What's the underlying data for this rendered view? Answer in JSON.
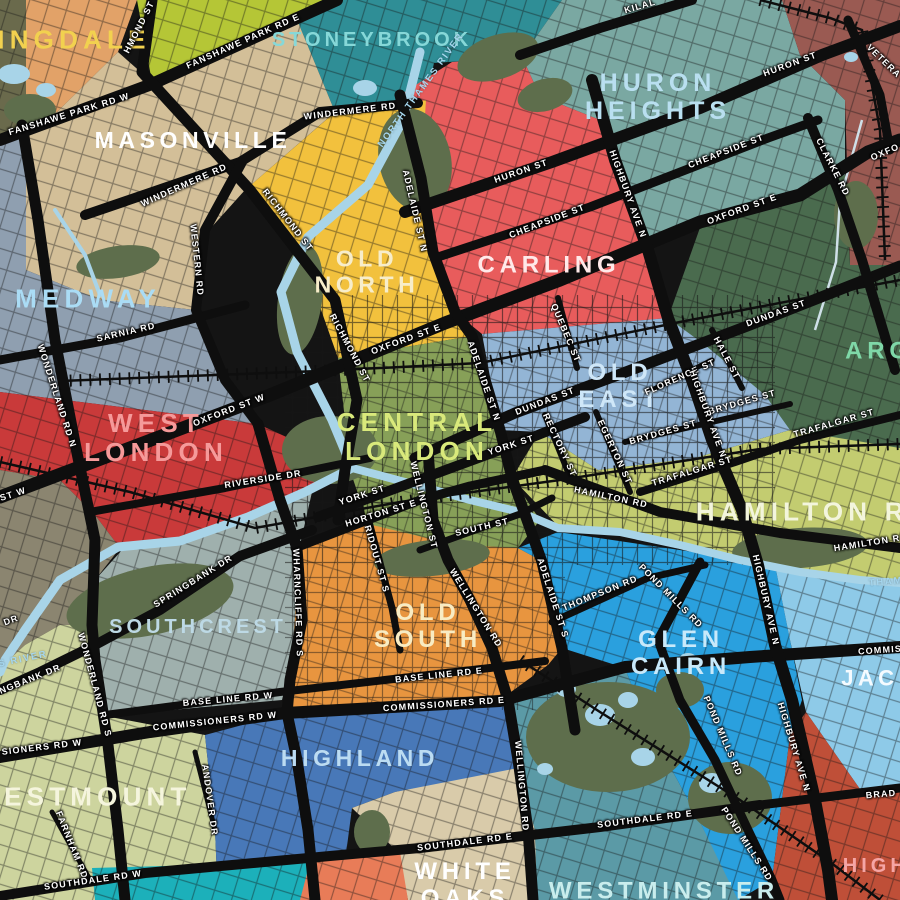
{
  "palette": {
    "background": "#141414",
    "road": "#0e0e0e",
    "rail": "#0e0e0e",
    "water": "#a8d4e8",
    "creek": "#cfe0e8",
    "park": "#5e6e4c"
  },
  "regions": [
    {
      "id": "corner-olive",
      "fill": "#6a6a4c"
    },
    {
      "id": "sunningdale",
      "fill": "#e2a268"
    },
    {
      "id": "lime-north",
      "fill": "#b5c636"
    },
    {
      "id": "stoneybrook",
      "fill": "#2f8e96"
    },
    {
      "id": "huron-heights",
      "fill": "#7aa8a2"
    },
    {
      "id": "northeast-maroon",
      "fill": "#9a5a52"
    },
    {
      "id": "argyle-green",
      "fill": "#4a6b4e"
    },
    {
      "id": "carling",
      "fill": "#e85c5c"
    },
    {
      "id": "old-north",
      "fill": "#f2c13d"
    },
    {
      "id": "masonville",
      "fill": "#d3bf98"
    },
    {
      "id": "medway",
      "fill": "#8f9fb0"
    },
    {
      "id": "west-london",
      "fill": "#c93a3a"
    },
    {
      "id": "oakridge-olive",
      "fill": "#8b8570"
    },
    {
      "id": "hamilton-road",
      "fill": "#c3cc70"
    },
    {
      "id": "central-london",
      "fill": "#87a058"
    },
    {
      "id": "old-east",
      "fill": "#93b5d5"
    },
    {
      "id": "old-south",
      "fill": "#e8953f"
    },
    {
      "id": "southcrest",
      "fill": "#9fb0ad"
    },
    {
      "id": "westmount",
      "fill": "#cdd49e"
    },
    {
      "id": "highland",
      "fill": "#4878b8"
    },
    {
      "id": "white-oaks",
      "fill": "#d9cbaa"
    },
    {
      "id": "westminster",
      "fill": "#5b9aa6"
    },
    {
      "id": "glen-cairn",
      "fill": "#2aa0de"
    },
    {
      "id": "jackson",
      "fill": "#8ecae8"
    },
    {
      "id": "highbury",
      "fill": "#bf4f38"
    },
    {
      "id": "bottom-teal",
      "fill": "#1cb0ba"
    },
    {
      "id": "bottom-coral",
      "fill": "#e87c58"
    }
  ],
  "neighbourhoods": [
    {
      "id": "sunningdale",
      "lines": [
        "NINGDALE"
      ],
      "x": 62,
      "y": 40,
      "size": 26,
      "color": "#f2d14f",
      "rot": 0
    },
    {
      "id": "masonville",
      "lines": [
        "MASONVILLE"
      ],
      "x": 193,
      "y": 141,
      "size": 23,
      "color": "#ffffff",
      "rot": 0
    },
    {
      "id": "stoneybrook",
      "lines": [
        "STONEYBROOK"
      ],
      "x": 372,
      "y": 40,
      "size": 20,
      "color": "#86d8d8",
      "rot": 0
    },
    {
      "id": "huron-heights",
      "lines": [
        "HURON",
        "HEIGHTS"
      ],
      "x": 658,
      "y": 97,
      "size": 25,
      "color": "#b9dff0",
      "rot": 0
    },
    {
      "id": "medway",
      "lines": [
        "MEDWAY"
      ],
      "x": 88,
      "y": 299,
      "size": 26,
      "color": "#aadcf5",
      "rot": 0
    },
    {
      "id": "old-north",
      "lines": [
        "OLD",
        "NORTH"
      ],
      "x": 367,
      "y": 272,
      "size": 23,
      "color": "#f7edca",
      "rot": 0
    },
    {
      "id": "carling",
      "lines": [
        "CARLING"
      ],
      "x": 549,
      "y": 266,
      "size": 24,
      "color": "#ffe9e9",
      "rot": 0
    },
    {
      "id": "west-london",
      "lines": [
        "WEST",
        "LONDON"
      ],
      "x": 156,
      "y": 438,
      "size": 26,
      "color": "#f59a9a",
      "rot": 0
    },
    {
      "id": "central-london",
      "lines": [
        "CENTRAL",
        "LONDON"
      ],
      "x": 417,
      "y": 437,
      "size": 26,
      "color": "#d9e97b",
      "rot": 0
    },
    {
      "id": "old-east",
      "lines": [
        "OLD",
        "EAST"
      ],
      "x": 620,
      "y": 387,
      "size": 24,
      "color": "#cfe7f8",
      "rot": 0
    },
    {
      "id": "hamilton-road",
      "lines": [
        "HAMILTON RO"
      ],
      "x": 815,
      "y": 512,
      "size": 26,
      "color": "#f3f5dc",
      "rot": 0
    },
    {
      "id": "argyle",
      "lines": [
        "ARG"
      ],
      "x": 879,
      "y": 352,
      "size": 24,
      "color": "#7fd8a8",
      "rot": 0
    },
    {
      "id": "old-south",
      "lines": [
        "OLD",
        "SOUTH"
      ],
      "x": 428,
      "y": 627,
      "size": 24,
      "color": "#f8ecc3",
      "rot": 0
    },
    {
      "id": "glen-cairn",
      "lines": [
        "GLEN",
        "CAIRN"
      ],
      "x": 681,
      "y": 654,
      "size": 24,
      "color": "#c8e9fa",
      "rot": 0
    },
    {
      "id": "southcrest",
      "lines": [
        "SOUTHCREST"
      ],
      "x": 198,
      "y": 627,
      "size": 20,
      "color": "#bdd9e5",
      "rot": 0
    },
    {
      "id": "westmount",
      "lines": [
        "WESTMOUNT"
      ],
      "x": 83,
      "y": 797,
      "size": 26,
      "color": "#f5f5dd",
      "rot": 0
    },
    {
      "id": "highland",
      "lines": [
        "HIGHLAND"
      ],
      "x": 360,
      "y": 759,
      "size": 23,
      "color": "#bcdcf2",
      "rot": 0
    },
    {
      "id": "white-oaks",
      "lines": [
        "WHITE",
        "OAKS"
      ],
      "x": 465,
      "y": 886,
      "size": 24,
      "color": "#ffffff",
      "rot": 0
    },
    {
      "id": "westminster",
      "lines": [
        "WESTMINSTER"
      ],
      "x": 664,
      "y": 892,
      "size": 24,
      "color": "#c9eded",
      "rot": 0
    },
    {
      "id": "jackson",
      "lines": [
        "JACK"
      ],
      "x": 880,
      "y": 679,
      "size": 22,
      "color": "#f5fbff",
      "rot": 0
    },
    {
      "id": "highbury",
      "lines": [
        "HIGHB"
      ],
      "x": 885,
      "y": 866,
      "size": 20,
      "color": "#f5a5a5",
      "rot": 0
    }
  ],
  "streets": [
    {
      "t": "FANSHAWE PARK RD W",
      "x": 69,
      "y": 114,
      "r": -17
    },
    {
      "t": "FANSHAWE PARK RD E",
      "x": 243,
      "y": 41,
      "r": -24
    },
    {
      "t": "HMOND ST",
      "x": 139,
      "y": 27,
      "r": -63
    },
    {
      "t": "KILAL",
      "x": 640,
      "y": 6,
      "r": -16
    },
    {
      "t": "HURON ST",
      "x": 790,
      "y": 64,
      "r": -20
    },
    {
      "t": "VETERA",
      "x": 884,
      "y": 61,
      "r": 44
    },
    {
      "t": "WINDERMERE RD",
      "x": 350,
      "y": 111,
      "r": -7
    },
    {
      "t": "WINDERMERE RD",
      "x": 184,
      "y": 185,
      "r": -24
    },
    {
      "t": "RICHMOND ST",
      "x": 288,
      "y": 220,
      "r": 52
    },
    {
      "t": "ADELAIDE ST N",
      "x": 415,
      "y": 211,
      "r": 77
    },
    {
      "t": "WESTERN RD",
      "x": 197,
      "y": 260,
      "r": 84
    },
    {
      "t": "CHEAPSIDE ST",
      "x": 726,
      "y": 151,
      "r": -21
    },
    {
      "t": "CHEAPSIDE ST",
      "x": 547,
      "y": 221,
      "r": -21
    },
    {
      "t": "HURON ST",
      "x": 521,
      "y": 171,
      "r": -19
    },
    {
      "t": "HIGHBURY AVE N",
      "x": 628,
      "y": 194,
      "r": 70
    },
    {
      "t": "CLARKE RD",
      "x": 833,
      "y": 167,
      "r": 63
    },
    {
      "t": "OXFO",
      "x": 885,
      "y": 152,
      "r": -23
    },
    {
      "t": "OXFORD ST E",
      "x": 742,
      "y": 209,
      "r": -20
    },
    {
      "t": "OXFORD ST E",
      "x": 406,
      "y": 339,
      "r": -20
    },
    {
      "t": "OXFORD ST W",
      "x": 229,
      "y": 410,
      "r": -21
    },
    {
      "t": "ST W",
      "x": 13,
      "y": 494,
      "r": -18
    },
    {
      "t": "SARNIA RD",
      "x": 126,
      "y": 332,
      "r": -13
    },
    {
      "t": "WONDERLAND RD N",
      "x": 57,
      "y": 396,
      "r": 72
    },
    {
      "t": "RICHMOND ST",
      "x": 350,
      "y": 348,
      "r": 62
    },
    {
      "t": "QUEBEC ST",
      "x": 566,
      "y": 333,
      "r": 67
    },
    {
      "t": "DUNDAS ST",
      "x": 545,
      "y": 401,
      "r": -21
    },
    {
      "t": "DUNDAS ST",
      "x": 776,
      "y": 313,
      "r": -20
    },
    {
      "t": "FLORENCE ST",
      "x": 680,
      "y": 377,
      "r": -24
    },
    {
      "t": "HALE ST",
      "x": 727,
      "y": 358,
      "r": 62
    },
    {
      "t": "BRYDGES ST",
      "x": 663,
      "y": 432,
      "r": -16
    },
    {
      "t": "BRYDGES ST",
      "x": 742,
      "y": 402,
      "r": -16
    },
    {
      "t": "EGERTON ST",
      "x": 615,
      "y": 452,
      "r": 65
    },
    {
      "t": "RECTORY ST",
      "x": 560,
      "y": 445,
      "r": 65
    },
    {
      "t": "TRAFALGAR ST",
      "x": 834,
      "y": 423,
      "r": -16
    },
    {
      "t": "TRAFALGAR ST",
      "x": 692,
      "y": 471,
      "r": -17
    },
    {
      "t": "YORK ST",
      "x": 511,
      "y": 445,
      "r": -18
    },
    {
      "t": "YORK ST",
      "x": 362,
      "y": 495,
      "r": -18
    },
    {
      "t": "HORTON ST E",
      "x": 381,
      "y": 513,
      "r": -17
    },
    {
      "t": "WELLINGTON ST",
      "x": 424,
      "y": 505,
      "r": 76
    },
    {
      "t": "SOUTH ST",
      "x": 482,
      "y": 527,
      "r": -13
    },
    {
      "t": "HAMILTON RD",
      "x": 611,
      "y": 497,
      "r": 12
    },
    {
      "t": "HAMILTON R",
      "x": 867,
      "y": 543,
      "r": -9
    },
    {
      "t": "RIDOUT ST S",
      "x": 377,
      "y": 559,
      "r": 74
    },
    {
      "t": "WHARNCLIFFE RD S",
      "x": 298,
      "y": 603,
      "r": 88
    },
    {
      "t": "WELLINGTON RD",
      "x": 476,
      "y": 608,
      "r": 58
    },
    {
      "t": "WELLINGTON RD",
      "x": 522,
      "y": 786,
      "r": 85
    },
    {
      "t": "ADELAIDE ST S",
      "x": 553,
      "y": 598,
      "r": 72
    },
    {
      "t": "THOMPSON RD",
      "x": 600,
      "y": 593,
      "r": -22
    },
    {
      "t": "POND MILLS RD",
      "x": 671,
      "y": 596,
      "r": 45
    },
    {
      "t": "POND MILLS RD",
      "x": 723,
      "y": 736,
      "r": 67
    },
    {
      "t": "POND MILLS RD",
      "x": 747,
      "y": 844,
      "r": 57
    },
    {
      "t": "BASE LINE RD E",
      "x": 439,
      "y": 675,
      "r": -6
    },
    {
      "t": "BASE LINE RD W",
      "x": 228,
      "y": 699,
      "r": -5
    },
    {
      "t": "COMMISSIONERS RD E",
      "x": 444,
      "y": 704,
      "r": -4
    },
    {
      "t": "COMMIS",
      "x": 880,
      "y": 650,
      "r": -4
    },
    {
      "t": "COMMISSIONERS RD W",
      "x": 215,
      "y": 721,
      "r": -6
    },
    {
      "t": "SIONERS RD W",
      "x": 42,
      "y": 747,
      "r": -7
    },
    {
      "t": "SPRINGBANK DR",
      "x": 193,
      "y": 581,
      "r": -32
    },
    {
      "t": "NGBANK DR",
      "x": 30,
      "y": 679,
      "r": -22
    },
    {
      "t": "ANDOVER DR",
      "x": 210,
      "y": 800,
      "r": 82
    },
    {
      "t": "FARNHAM RD",
      "x": 72,
      "y": 845,
      "r": 68
    },
    {
      "t": "SOUTHDALE RD W",
      "x": 93,
      "y": 880,
      "r": -8
    },
    {
      "t": "SOUTHDALE RD E",
      "x": 465,
      "y": 842,
      "r": -7
    },
    {
      "t": "SOUTHDALE RD E",
      "x": 645,
      "y": 819,
      "r": -7
    },
    {
      "t": "BRAD",
      "x": 881,
      "y": 794,
      "r": -5
    },
    {
      "t": "HIGHBURY AVE N",
      "x": 708,
      "y": 414,
      "r": 70
    },
    {
      "t": "HIGHBURY AVE N",
      "x": 766,
      "y": 600,
      "r": 77
    },
    {
      "t": "HIGHBURY AVE N",
      "x": 794,
      "y": 747,
      "r": 73
    },
    {
      "t": "WONDERLAND RD S",
      "x": 95,
      "y": 685,
      "r": 75
    },
    {
      "t": "RIVERSIDE DR",
      "x": 263,
      "y": 479,
      "r": -9
    },
    {
      "t": "DR",
      "x": 11,
      "y": 620,
      "r": -20
    },
    {
      "t": "ADELAIDE ST N",
      "x": 484,
      "y": 381,
      "r": 71
    }
  ],
  "water_labels": [
    {
      "t": "NORTH THAMES RIVER",
      "x": 421,
      "y": 90,
      "r": -54
    },
    {
      "t": "ES RIVER",
      "x": 19,
      "y": 660,
      "r": -12
    },
    {
      "t": "THAM",
      "x": 886,
      "y": 582,
      "r": -5
    }
  ]
}
